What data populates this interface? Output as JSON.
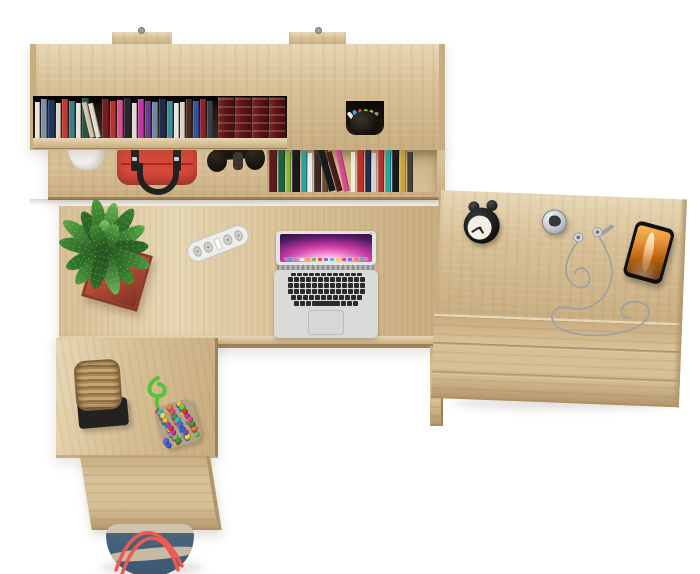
{
  "scene": {
    "background": "#ffffff"
  },
  "palette": {
    "wood": "#d8c096",
    "wood_light": "#e7d7b4",
    "wood_mid": "#c8ad80",
    "wood_dark": "#b2966a",
    "wood_edge": "#9d8257",
    "interior": "#20170f"
  },
  "shelf": {
    "screw_color": "#9ba1a7",
    "upper_books": [
      {
        "c": "#e8e5de",
        "h": 86,
        "w": 5
      },
      {
        "c": "#7d90a8",
        "h": 94,
        "w": 6
      },
      {
        "c": "#22365c",
        "h": 90,
        "w": 7
      },
      {
        "c": "#d9d4c6",
        "h": 84,
        "w": 5
      },
      {
        "c": "#c23a31",
        "h": 92,
        "w": 6
      },
      {
        "c": "#3d7e89",
        "h": 88,
        "w": 6
      },
      {
        "c": "#e6e2d8",
        "h": 83,
        "w": 5
      },
      {
        "c": "#2a5240",
        "h": 95,
        "w": 7
      },
      {
        "c": "#d2c8a8",
        "h": 86,
        "w": 5,
        "r": -13
      },
      {
        "c": "#e3decf",
        "h": 84,
        "w": 5,
        "r": -13
      },
      {
        "c": "#6e2026",
        "h": 93,
        "w": 7
      },
      {
        "c": "#b8332b",
        "h": 88,
        "w": 6
      },
      {
        "c": "#d84f92",
        "h": 90,
        "w": 6
      },
      {
        "c": "#27282e",
        "h": 95,
        "w": 7
      },
      {
        "c": "#e0dbcd",
        "h": 84,
        "w": 5
      },
      {
        "c": "#c437a3",
        "h": 92,
        "w": 6
      },
      {
        "c": "#6a3d91",
        "h": 89,
        "w": 6
      },
      {
        "c": "#73849e",
        "h": 86,
        "w": 6
      },
      {
        "c": "#1e2c4e",
        "h": 94,
        "w": 7
      },
      {
        "c": "#3a8f99",
        "h": 88,
        "w": 6
      },
      {
        "c": "#e9e6df",
        "h": 83,
        "w": 5
      },
      {
        "c": "#d9d2c0",
        "h": 86,
        "w": 5
      },
      {
        "c": "#4a2c1e",
        "h": 92,
        "w": 6
      },
      {
        "c": "#2f55a0",
        "h": 89,
        "w": 6
      },
      {
        "c": "#8c2230",
        "h": 93,
        "w": 6
      },
      {
        "c": "#3b3f4a",
        "h": 87,
        "w": 6
      }
    ],
    "book_set": {
      "color": "#5c151b",
      "gold": "#c79a4b",
      "spines": 4
    },
    "pen_cup": {
      "cup": "#141110",
      "pens": [
        "#e8e6e2",
        "#49a0d5",
        "#cf4438",
        "#8ec63f",
        "#d9b62c",
        "#8d9096"
      ]
    },
    "flower_pot": {
      "pot": "#f5f3ef",
      "soil": "#2a1012",
      "flowers": [
        "#8e2430",
        "#b3404d",
        "#6f1b25"
      ]
    },
    "handbag": {
      "body": "#d8483a",
      "body_dark": "#a72a20",
      "straps": "#26221f",
      "buckles": "#d0d4d7"
    },
    "headphones": {
      "body": "#17130f",
      "shine": "#3c362f"
    },
    "lower_books": [
      {
        "c": "#5d191e",
        "h": 90,
        "w": 8
      },
      {
        "c": "#24603a",
        "h": 95,
        "w": 7
      },
      {
        "c": "#8ab43d",
        "h": 85,
        "w": 5
      },
      {
        "c": "#17191d",
        "h": 97,
        "w": 8
      },
      {
        "c": "#2ba3a8",
        "h": 88,
        "w": 6
      },
      {
        "c": "#eeebe2",
        "h": 84,
        "w": 5
      },
      {
        "c": "#3d2a20",
        "h": 96,
        "w": 7
      },
      {
        "c": "#6b4e31",
        "h": 90,
        "w": 6
      },
      {
        "c": "#17191d",
        "h": 94,
        "w": 7,
        "r": -16
      },
      {
        "c": "#461d18",
        "h": 88,
        "w": 6,
        "r": -16
      },
      {
        "c": "#d8498b",
        "h": 92,
        "w": 6,
        "r": -12
      },
      {
        "c": "#efece4",
        "h": 86,
        "w": 5
      },
      {
        "c": "#bc3130",
        "h": 95,
        "w": 7
      },
      {
        "c": "#202a52",
        "h": 90,
        "w": 6
      },
      {
        "c": "#d8d3c8",
        "h": 84,
        "w": 5
      },
      {
        "c": "#b93030",
        "h": 93,
        "w": 6
      },
      {
        "c": "#2ba3a8",
        "h": 89,
        "w": 6
      },
      {
        "c": "#17191d",
        "h": 96,
        "w": 7
      },
      {
        "c": "#c9a43b",
        "h": 90,
        "w": 6
      },
      {
        "c": "#44403a",
        "h": 86,
        "w": 6
      }
    ]
  },
  "desk": {
    "plant": {
      "pot_light": "#cf6448",
      "pot_dark": "#7e3121",
      "leaves": [
        {
          "a": -80,
          "l": 46,
          "c": "#3f8c33"
        },
        {
          "a": -55,
          "l": 50,
          "c": "#55a844"
        },
        {
          "a": -30,
          "l": 44,
          "c": "#2f6b28"
        },
        {
          "a": -10,
          "l": 52,
          "c": "#4a9a3c"
        },
        {
          "a": 12,
          "l": 48,
          "c": "#66b553"
        },
        {
          "a": 35,
          "l": 50,
          "c": "#358031"
        },
        {
          "a": 60,
          "l": 46,
          "c": "#55a844"
        },
        {
          "a": 85,
          "l": 44,
          "c": "#2f6b28"
        },
        {
          "a": 110,
          "l": 48,
          "c": "#4a9a3c"
        },
        {
          "a": 140,
          "l": 44,
          "c": "#3f8c33"
        },
        {
          "a": 165,
          "l": 46,
          "c": "#66b553"
        },
        {
          "a": -115,
          "l": 42,
          "c": "#358031"
        },
        {
          "a": -140,
          "l": 44,
          "c": "#4a9a3c"
        },
        {
          "a": -165,
          "l": 40,
          "c": "#2f6b28"
        },
        {
          "a": 0,
          "l": 30,
          "c": "#77c25e"
        },
        {
          "a": 25,
          "l": 28,
          "c": "#55a844"
        },
        {
          "a": -25,
          "l": 28,
          "c": "#3f8c33"
        }
      ]
    },
    "power_strip": {
      "body": "#ededeb"
    },
    "laptop": {
      "shell": "#e4e4e2",
      "deck": "#dadad8",
      "hinge": "#b4b4b2",
      "screen_sky": [
        "#13071f",
        "#5b1b67",
        "#c63ba2",
        "#f78ad0",
        "#ffd4ee"
      ],
      "dock": [
        "#4aa3e8",
        "#9aa0a6",
        "#eceff1",
        "#f2a73b",
        "#58c24f",
        "#e0503a",
        "#8f5fc6",
        "#3fc1d4",
        "#f2ce44",
        "#d44a84",
        "#6a78d1",
        "#e8853a",
        "#50b7a0"
      ],
      "key": "#2c2b29",
      "trackpad": "#d7d7d5",
      "camera_dot": "#c5c8cc",
      "key_rows": [
        12,
        13,
        13,
        13,
        12
      ]
    }
  },
  "drawer_unit": {
    "clock": {
      "body": "#1a1a1a",
      "face": "#f3efe5",
      "hands": "#22211f"
    },
    "bell": {
      "shell_light": "#f2f4f5",
      "shell_dark": "#8d9298",
      "center": "#35383c"
    },
    "earphones": {
      "cable": "#9aa0a6"
    },
    "phone": {
      "body": "#12100d",
      "screen_top": "#f7bc52",
      "screen_deep": "#5e2a07"
    }
  },
  "return_unit": {
    "basket": {
      "weave_light": "#c9a671",
      "weave_dark": "#8f7146",
      "rim": "#7c6139",
      "stand": "#242220"
    },
    "bead_bag": {
      "rope": "#58c23d",
      "pouch": "#b3a286",
      "beads": {
        "count": 62,
        "colors": [
          "#d93a34",
          "#3a9e4a",
          "#3562c9",
          "#f2c230",
          "#c238b5",
          "#f07f2e",
          "#35b8c9",
          "#8a46c9",
          "#77c94a",
          "#e05577",
          "#4a6fe0",
          "#e8e23a"
        ]
      }
    }
  },
  "floor_bag": {
    "rim": "#cfc3ac",
    "body": "#4a6580",
    "body_dark": "#3a5671",
    "wave": "#c6baa3",
    "handles": "#ec5a52"
  }
}
